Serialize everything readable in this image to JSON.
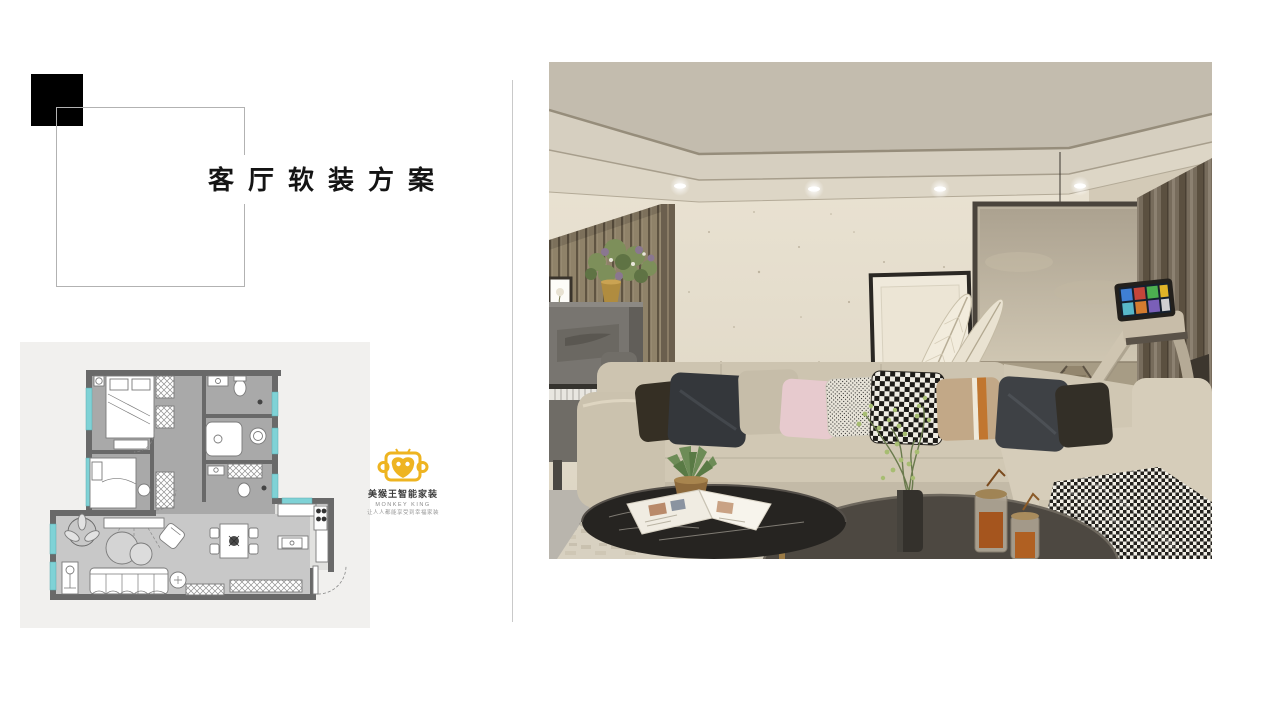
{
  "slide": {
    "background": "#ffffff",
    "title": "客厅软装方案",
    "title_color": "#141414"
  },
  "decor": {
    "black_square_color": "#000000",
    "outline_square_border": "#b2b2b2",
    "divider_color": "#c9c9c9"
  },
  "floor_plan": {
    "name": "apartment-floor-plan-thumbnail",
    "card_background": "#f1f0ee",
    "wall_color": "#696969",
    "bedroom_floor": "#a9a9a9",
    "living_floor": "#c8c8c8",
    "window_color": "#7fd2d6"
  },
  "brand": {
    "icon": "monkey-king-logo-icon",
    "icon_color": "#eeb421",
    "name_cn": "美猴王智能家装",
    "name_en": "MONKEY KING",
    "tagline": "让人人都能享受到幸福家装"
  },
  "render_photo": {
    "name": "living-room-render",
    "palette": {
      "wall": "#e7e0d0",
      "ceiling": "#c6bfb0",
      "wood_slats": "#8d8069",
      "curtain": "#756a5a",
      "sofa": "#cfc6b3",
      "rug": "#d8d1c1",
      "coffee_table_dark": "#4d4841",
      "marble_table": "#262421",
      "pillow_pink": "#e7cace",
      "pillow_orange_stripe": "#c1762f"
    }
  }
}
